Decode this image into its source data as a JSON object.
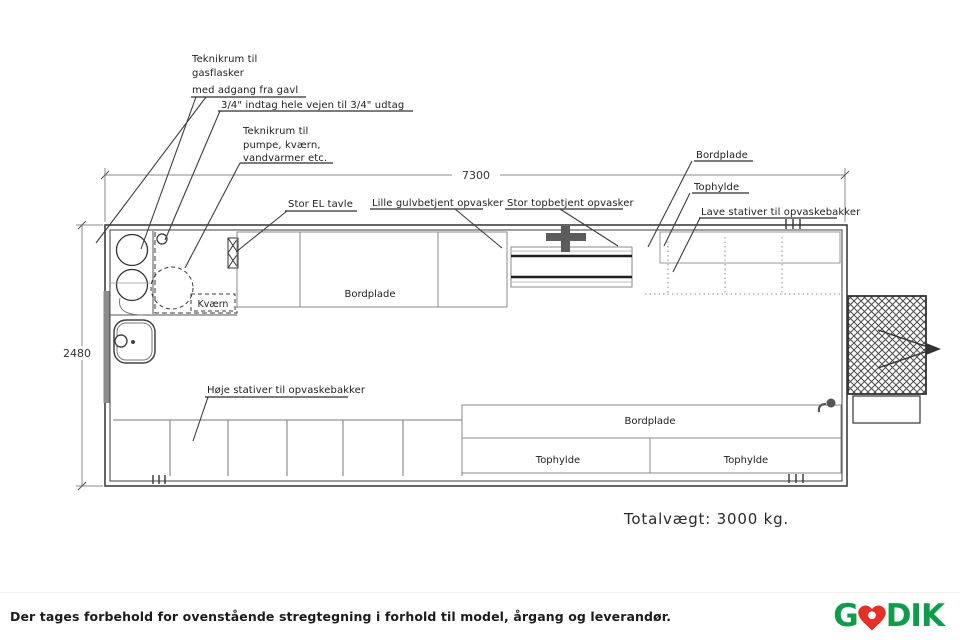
{
  "plan": {
    "annotations": {
      "teknikrum_gas": {
        "line1": "Teknikrum til",
        "line2": "gasflasker",
        "line3": "med adgang fra gavl"
      },
      "pipe_note": "3/4\" indtag hele vejen til 3/4\" udtag",
      "teknikrum_pumpe": {
        "line1": "Teknikrum til",
        "line2": "pumpe, kværn,",
        "line3": "vandvarmer etc."
      },
      "el_board": "Stor EL tavle",
      "small_dishwasher": "Lille gulvbetjent opvasker",
      "large_dishwasher": "Stor topbetjent opvasker",
      "countertop_top_right": "Bordplade",
      "top_shelf_right": "Tophylde",
      "low_racks": "Lave stativer til opvaskebakker",
      "countertop_top": "Bordplade",
      "grinder": "Kværn",
      "tall_racks": "Høje stativer til opvaskebakker",
      "countertop_bottom": "Bordplade",
      "top_shelf_bottom_left": "Tophylde",
      "top_shelf_bottom_right": "Tophylde"
    },
    "dimensions": {
      "length_mm": "7300",
      "width_mm": "2480"
    },
    "total_weight": "Totalvægt: 3000 kg."
  },
  "footer": {
    "disclaimer": "Der tages forbehold for ovenstående stregtegning i forhold til model, årgang og leverandør.",
    "logo": {
      "part1": "G",
      "part2": "DIK",
      "heart_icon": "heart-icon",
      "green": "#0f9d4c",
      "red": "#e53028"
    }
  }
}
